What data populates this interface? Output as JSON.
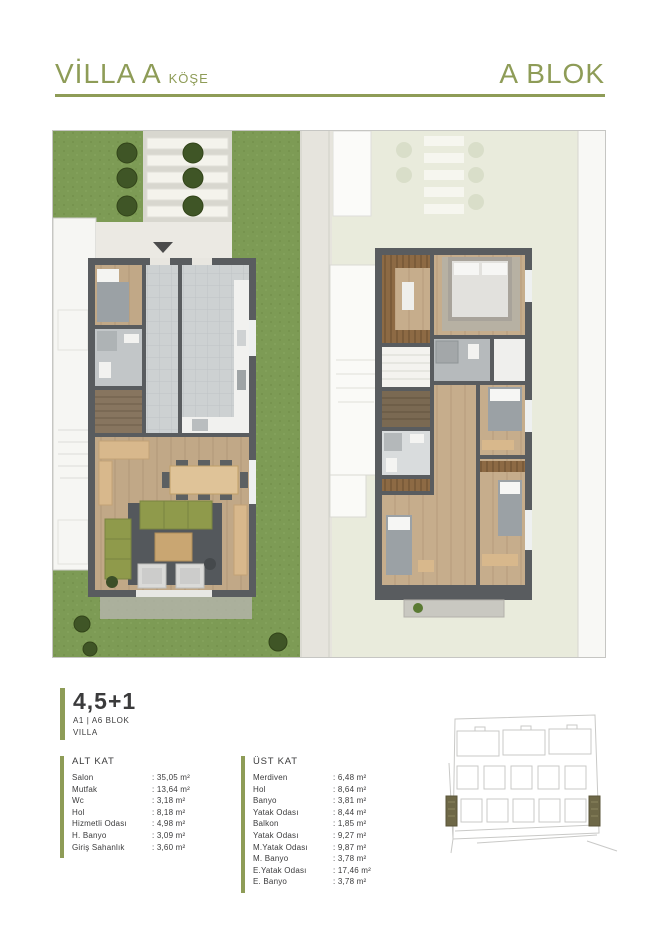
{
  "header": {
    "title": "VİLLA A",
    "title_suffix": "KÖŞE",
    "block": "A BLOK"
  },
  "unit": {
    "type": "4,5+1",
    "blocks": "A1 | A6 BLOK",
    "label": "VILLA"
  },
  "floors": {
    "alt": {
      "title": "ALT KAT",
      "rows": [
        {
          "name": "Salon",
          "area": ": 35,05 m²"
        },
        {
          "name": "Mutfak",
          "area": ": 13,64 m²"
        },
        {
          "name": "Wc",
          "area": ": 3,18 m²"
        },
        {
          "name": "Hol",
          "area": ": 8,18 m²"
        },
        {
          "name": "Hizmetli Odası",
          "area": ": 4,98 m²"
        },
        {
          "name": "H. Banyo",
          "area": ": 3,09 m²"
        },
        {
          "name": "Giriş Sahanlık",
          "area": ": 3,60 m²"
        }
      ]
    },
    "ust": {
      "title": "ÜST KAT",
      "rows": [
        {
          "name": "Merdiven",
          "area": ": 6,48 m²"
        },
        {
          "name": "Hol",
          "area": ": 8,64 m²"
        },
        {
          "name": "Banyo",
          "area": ": 3,81 m²"
        },
        {
          "name": "Yatak Odası",
          "area": ": 8,44 m²"
        },
        {
          "name": "Balkon",
          "area": ": 1,85 m²"
        },
        {
          "name": "Yatak Odası",
          "area": ": 9,27 m²"
        },
        {
          "name": "M.Yatak Odası",
          "area": ": 9,87 m²"
        },
        {
          "name": "M. Banyo",
          "area": ": 3,78 m²"
        },
        {
          "name": "E.Yatak Odası",
          "area": ": 17,46 m²"
        },
        {
          "name": "E. Banyo",
          "area": ": 3,78 m²"
        }
      ]
    }
  },
  "colors": {
    "accent": "#8e9c57",
    "text_dark": "#3b3b3c",
    "grass": "#7d9b55",
    "pale_bg": "#e9ebdc",
    "wall": "#595c5f",
    "tile": "#cdd1d2",
    "wood": "#c1a887",
    "rug": "#54585c",
    "sofa": "#8f9a4b",
    "site_highlight": "#6e6847"
  }
}
